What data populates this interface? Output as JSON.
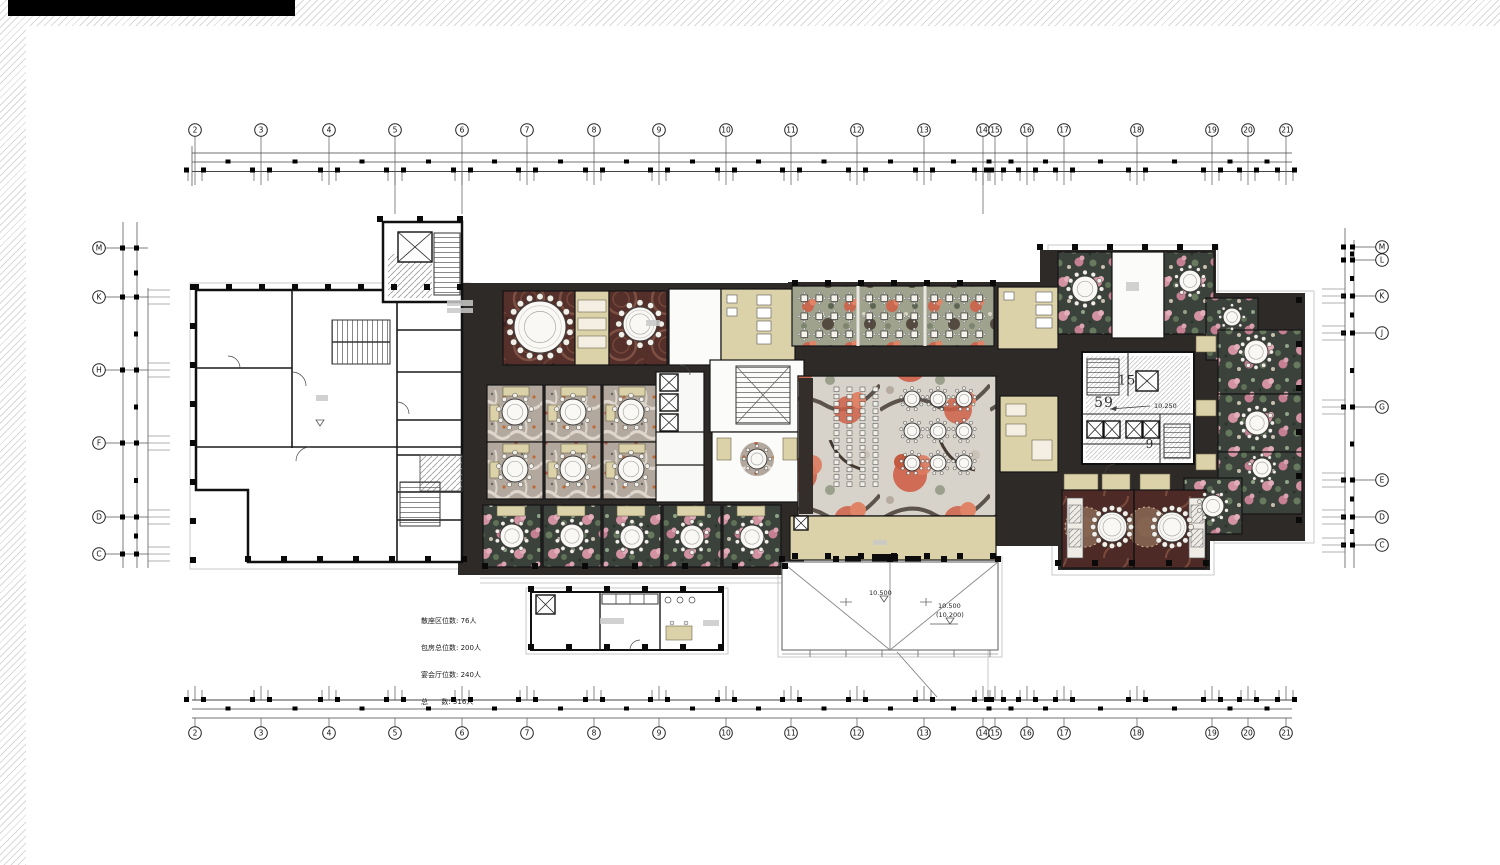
{
  "sheet": {
    "width": 1500,
    "height": 865
  },
  "stats_block": {
    "lines": [
      "散座区位数: 76人",
      "包房总位数: 200人",
      "宴会厅位数: 240人",
      "总      数: 516人"
    ]
  },
  "core": {
    "label_15": "15",
    "label_59": "59",
    "label_9": "9"
  },
  "elevations": [
    {
      "t": "10.250",
      "x": 1154,
      "y": 406
    },
    {
      "t": "10.500",
      "x": 869,
      "y": 593
    },
    {
      "t": "10.500",
      "x": 938,
      "y": 606
    },
    {
      "t": "(10.200)",
      "x": 936,
      "y": 615
    }
  ],
  "grid": {
    "top": {
      "cy": 130,
      "labels": [
        {
          "t": "2",
          "x": 195
        },
        {
          "t": "3",
          "x": 261
        },
        {
          "t": "4",
          "x": 329
        },
        {
          "t": "5",
          "x": 395
        },
        {
          "t": "6",
          "x": 462
        },
        {
          "t": "7",
          "x": 527
        },
        {
          "t": "8",
          "x": 594
        },
        {
          "t": "9",
          "x": 659
        },
        {
          "t": "10",
          "x": 726
        },
        {
          "t": "11",
          "x": 791
        },
        {
          "t": "12",
          "x": 857
        },
        {
          "t": "13",
          "x": 924
        },
        {
          "t": "14",
          "x": 983
        },
        {
          "t": "15",
          "x": 995
        },
        {
          "t": "16",
          "x": 1027
        },
        {
          "t": "17",
          "x": 1064
        },
        {
          "t": "18",
          "x": 1137
        },
        {
          "t": "19",
          "x": 1212
        },
        {
          "t": "20",
          "x": 1248
        },
        {
          "t": "21",
          "x": 1286
        }
      ]
    },
    "bottom": {
      "cy": 733
    },
    "left": {
      "cx": 99,
      "labels": [
        {
          "t": "M",
          "y": 248
        },
        {
          "t": "K",
          "y": 297
        },
        {
          "t": "H",
          "y": 370
        },
        {
          "t": "F",
          "y": 443
        },
        {
          "t": "D",
          "y": 517
        },
        {
          "t": "C",
          "y": 554
        }
      ]
    },
    "right": {
      "cx": 1382,
      "labels": [
        {
          "t": "M",
          "y": 247
        },
        {
          "t": "L",
          "y": 260
        },
        {
          "t": "K",
          "y": 296
        },
        {
          "t": "J",
          "y": 333
        },
        {
          "t": "G",
          "y": 407
        },
        {
          "t": "E",
          "y": 480
        },
        {
          "t": "D",
          "y": 517
        },
        {
          "t": "C",
          "y": 545
        }
      ]
    }
  },
  "plan": {
    "colors": {
      "wall": "#111111",
      "dark_floor": "#2d2a27",
      "beige": "#dcd2a9",
      "maroon_carpet": "#55302a",
      "maroon2_carpet": "#4d2a25",
      "pink_floral_carpet": "#3a423b",
      "pink": "#d292a2",
      "feather_carpet": "#b2a89d",
      "dining_carpet": "#9fa38e",
      "coral_flower": "#cf6148",
      "mural_base": "#d7d3cb"
    },
    "round_tables": [
      {
        "x": 540,
        "y": 327,
        "r": 26,
        "s": 18
      },
      {
        "x": 640,
        "y": 324,
        "r": 17,
        "s": 12
      },
      {
        "x": 515,
        "y": 412,
        "r": 13,
        "s": 9
      },
      {
        "x": 573,
        "y": 412,
        "r": 13,
        "s": 9
      },
      {
        "x": 631,
        "y": 412,
        "r": 13,
        "s": 9
      },
      {
        "x": 515,
        "y": 469,
        "r": 13,
        "s": 9
      },
      {
        "x": 573,
        "y": 469,
        "r": 13,
        "s": 9
      },
      {
        "x": 631,
        "y": 469,
        "r": 13,
        "s": 9
      },
      {
        "x": 757,
        "y": 459,
        "r": 10,
        "s": 8
      },
      {
        "x": 512,
        "y": 536,
        "r": 12,
        "s": 10
      },
      {
        "x": 572,
        "y": 536,
        "r": 12,
        "s": 10
      },
      {
        "x": 632,
        "y": 537,
        "r": 12,
        "s": 10
      },
      {
        "x": 692,
        "y": 537,
        "r": 12,
        "s": 10
      },
      {
        "x": 752,
        "y": 537,
        "r": 12,
        "s": 10
      },
      {
        "x": 912,
        "y": 399,
        "r": 8,
        "s": 9
      },
      {
        "x": 938,
        "y": 399,
        "r": 8,
        "s": 9
      },
      {
        "x": 964,
        "y": 399,
        "r": 8,
        "s": 9
      },
      {
        "x": 912,
        "y": 431,
        "r": 8,
        "s": 9
      },
      {
        "x": 938,
        "y": 431,
        "r": 8,
        "s": 9
      },
      {
        "x": 964,
        "y": 431,
        "r": 8,
        "s": 9
      },
      {
        "x": 912,
        "y": 463,
        "r": 8,
        "s": 9
      },
      {
        "x": 938,
        "y": 463,
        "r": 8,
        "s": 9
      },
      {
        "x": 964,
        "y": 463,
        "r": 8,
        "s": 9
      },
      {
        "x": 1085,
        "y": 289,
        "r": 13,
        "s": 12
      },
      {
        "x": 1190,
        "y": 281,
        "r": 11,
        "s": 10
      },
      {
        "x": 1232,
        "y": 317,
        "r": 9,
        "s": 8
      },
      {
        "x": 1256,
        "y": 352,
        "r": 12,
        "s": 12
      },
      {
        "x": 1257,
        "y": 423,
        "r": 12,
        "s": 12
      },
      {
        "x": 1262,
        "y": 468,
        "r": 10,
        "s": 10
      },
      {
        "x": 1213,
        "y": 506,
        "r": 11,
        "s": 10
      },
      {
        "x": 1112,
        "y": 527,
        "r": 15,
        "s": 16
      },
      {
        "x": 1172,
        "y": 527,
        "r": 15,
        "s": 16
      }
    ],
    "square_table_bays": [
      {
        "x": 801,
        "y": 295,
        "cols": 4,
        "rows": 3,
        "dx": 15,
        "dy": 18
      },
      {
        "x": 866,
        "y": 295,
        "cols": 4,
        "rows": 3,
        "dx": 15,
        "dy": 18
      },
      {
        "x": 931,
        "y": 295,
        "cols": 4,
        "rows": 3,
        "dx": 15,
        "dy": 18
      }
    ],
    "banquet_rows": {
      "x": 834,
      "y": 387,
      "cols": 4,
      "dx": 13,
      "rows": 14,
      "dy": 7.3
    },
    "shafts": [
      {
        "x": 398,
        "y": 232,
        "w": 34,
        "h": 30
      },
      {
        "x": 660,
        "y": 374,
        "w": 18,
        "h": 17
      },
      {
        "x": 660,
        "y": 394,
        "w": 18,
        "h": 17
      },
      {
        "x": 660,
        "y": 414,
        "w": 18,
        "h": 17
      },
      {
        "x": 1136,
        "y": 371,
        "w": 22,
        "h": 20
      },
      {
        "x": 1087,
        "y": 421,
        "w": 16,
        "h": 17
      },
      {
        "x": 1104,
        "y": 421,
        "w": 16,
        "h": 17
      },
      {
        "x": 1126,
        "y": 421,
        "w": 16,
        "h": 17
      },
      {
        "x": 1143,
        "y": 421,
        "w": 16,
        "h": 17
      },
      {
        "x": 794,
        "y": 516,
        "w": 14,
        "h": 14
      },
      {
        "x": 536,
        "y": 595,
        "w": 19,
        "h": 19
      }
    ],
    "column_rows": [
      {
        "x": 196,
        "y": 287,
        "n": 9,
        "dx": 33,
        "dy": 0
      },
      {
        "x": 193,
        "y": 287,
        "n": 8,
        "dx": 0,
        "dy": 39
      },
      {
        "x": 248,
        "y": 559,
        "n": 7,
        "dx": 36,
        "dy": 0
      },
      {
        "x": 485,
        "y": 566,
        "n": 7,
        "dx": 50,
        "dy": 0
      },
      {
        "x": 795,
        "y": 556,
        "n": 7,
        "dx": 33,
        "dy": 0
      },
      {
        "x": 795,
        "y": 283,
        "n": 7,
        "dx": 33,
        "dy": 0
      },
      {
        "x": 1040,
        "y": 247,
        "n": 6,
        "dx": 35,
        "dy": 0
      },
      {
        "x": 1299,
        "y": 300,
        "n": 6,
        "dx": 0,
        "dy": 44
      },
      {
        "x": 1058,
        "y": 563,
        "n": 5,
        "dx": 37,
        "dy": 0
      },
      {
        "x": 531,
        "y": 589,
        "n": 6,
        "dx": 38,
        "dy": 0
      },
      {
        "x": 531,
        "y": 647,
        "n": 6,
        "dx": 38,
        "dy": 0
      },
      {
        "x": 782,
        "y": 559,
        "n": 5,
        "dx": 54,
        "dy": 0
      },
      {
        "x": 380,
        "y": 219,
        "n": 3,
        "dx": 40,
        "dy": 0
      }
    ]
  }
}
